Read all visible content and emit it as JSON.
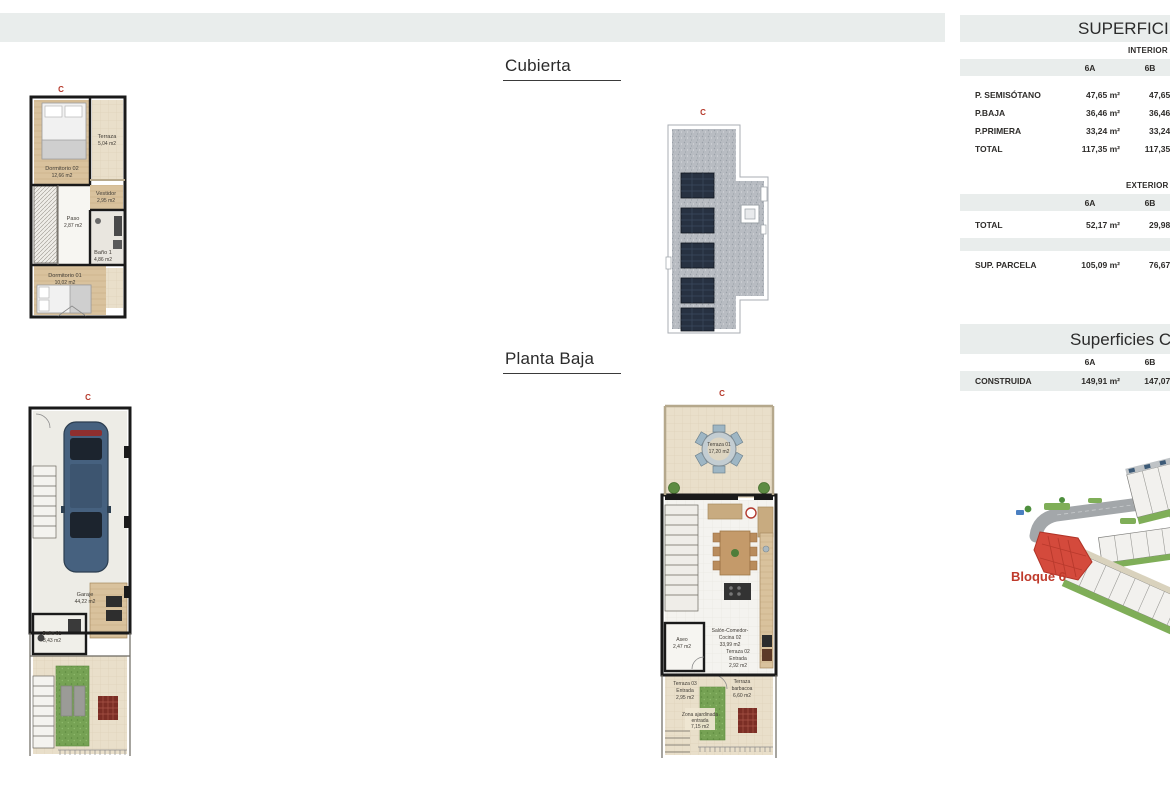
{
  "marker": "C",
  "titles": {
    "cubierta": "Cubierta",
    "planta_baja": "Planta Baja"
  },
  "tables": {
    "superficies": {
      "title": "SUPERFICIES",
      "interior": {
        "section_label": "INTERIOR",
        "columns": [
          "6A",
          "6B"
        ],
        "rows": [
          {
            "label": "P. SEMISÓTANO",
            "a": "47,65 m²",
            "b": "47,65 m²"
          },
          {
            "label": "P.BAJA",
            "a": "36,46 m²",
            "b": "36,46 m²"
          },
          {
            "label": "P.PRIMERA",
            "a": "33,24 m²",
            "b": "33,24 m²"
          },
          {
            "label": "TOTAL",
            "a": "117,35 m²",
            "b": "117,35 m²"
          }
        ]
      },
      "exterior": {
        "section_label": "EXTERIOR",
        "columns": [
          "6A",
          "6B"
        ],
        "rows": [
          {
            "label": "TOTAL",
            "a": "52,17 m²",
            "b": "29,98 m²"
          },
          {
            "label": "SUP. PARCELA",
            "a": "105,09 m²",
            "b": "76,67 m²"
          }
        ]
      }
    },
    "construidas": {
      "title": "Superficies Construidas",
      "columns": [
        "6A",
        "6B"
      ],
      "rows": [
        {
          "label": "CONSTRUIDA",
          "a": "149,91 m²",
          "b": "147,07 m²"
        }
      ]
    }
  },
  "plans": {
    "p1": {
      "rooms": {
        "dormitorio02": {
          "name": "Dormitorio 02",
          "area": "12,66 m2"
        },
        "terraza": {
          "name": "Terraza",
          "area": "5,04 m2"
        },
        "vestidor": {
          "name": "Vestidor",
          "area": "2,95 m2"
        },
        "paso": {
          "name": "Paso",
          "area": "2,87 m2"
        },
        "bano1": {
          "name": "Baño 1",
          "area": "4,86 m2"
        },
        "dormitorio01": {
          "name": "Dormitorio 01",
          "area": "10,02 m2"
        }
      }
    },
    "garage": {
      "rooms": {
        "garaje": {
          "name": "Garaje",
          "area": "44,22 m2"
        },
        "bano01": {
          "name": "Baño 01",
          "area": "3,43 m2"
        }
      }
    },
    "pb": {
      "rooms": {
        "terraza01": {
          "name": "Terraza 01",
          "area": "17,20 m2"
        },
        "salon": {
          "name": "Salón-Comedor-",
          "name2": "Cocina 02",
          "area": "33,99 m2"
        },
        "aseo": {
          "name": "Aseo",
          "area": "2,47 m2"
        },
        "terraza02": {
          "name": "Terraza 02",
          "name2": "Entrada",
          "area": "2,92 m2"
        },
        "terraza03": {
          "name": "Terraza 03",
          "name2": "Entrada",
          "area": "2,95 m2"
        },
        "barbacoa": {
          "name": "Terraza",
          "name2": "barbacoa",
          "area": "6,60 m2"
        },
        "zona": {
          "name": "Zona ajardinada",
          "name2": "entrada",
          "area": "7,15 m2"
        }
      }
    }
  },
  "site": {
    "label": "Bloque 6"
  }
}
